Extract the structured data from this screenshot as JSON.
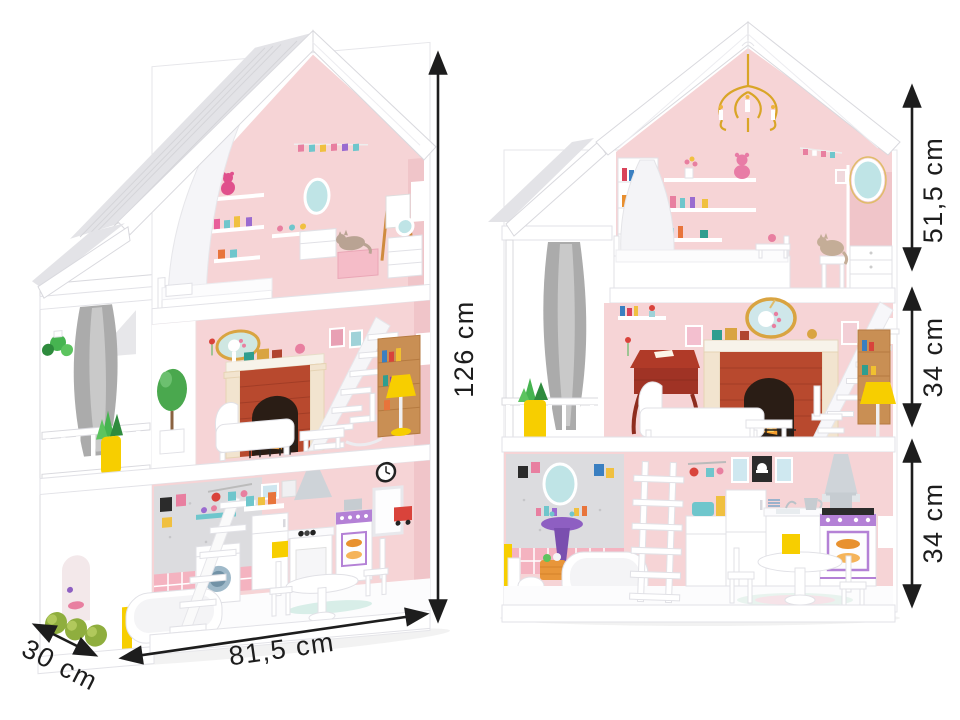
{
  "measurements": {
    "left_house": {
      "height": "126 cm",
      "width": "81,5 cm",
      "depth": "30 cm"
    },
    "right_house": {
      "attic_section_height": "51,5 cm",
      "middle_section_height": "34 cm",
      "bottom_section_height": "34 cm"
    }
  },
  "style": {
    "background": "#ffffff",
    "dimension_color": "#1d1d1d",
    "wall_pink": "#f6d4d6",
    "roof_white": "#ffffff",
    "roof_shade_gray": "#e3e3e7",
    "curtain_gray": "#ababab",
    "accent_yellow": "#f7ce00",
    "brick_red": "#b8492e",
    "wood_brown": "#c98f54",
    "mirror_teal": "#bfe4e6",
    "stove_purple": "#b481d6",
    "bath_tile_pink": "#f4b3c0",
    "plant_green": "#46b450"
  }
}
